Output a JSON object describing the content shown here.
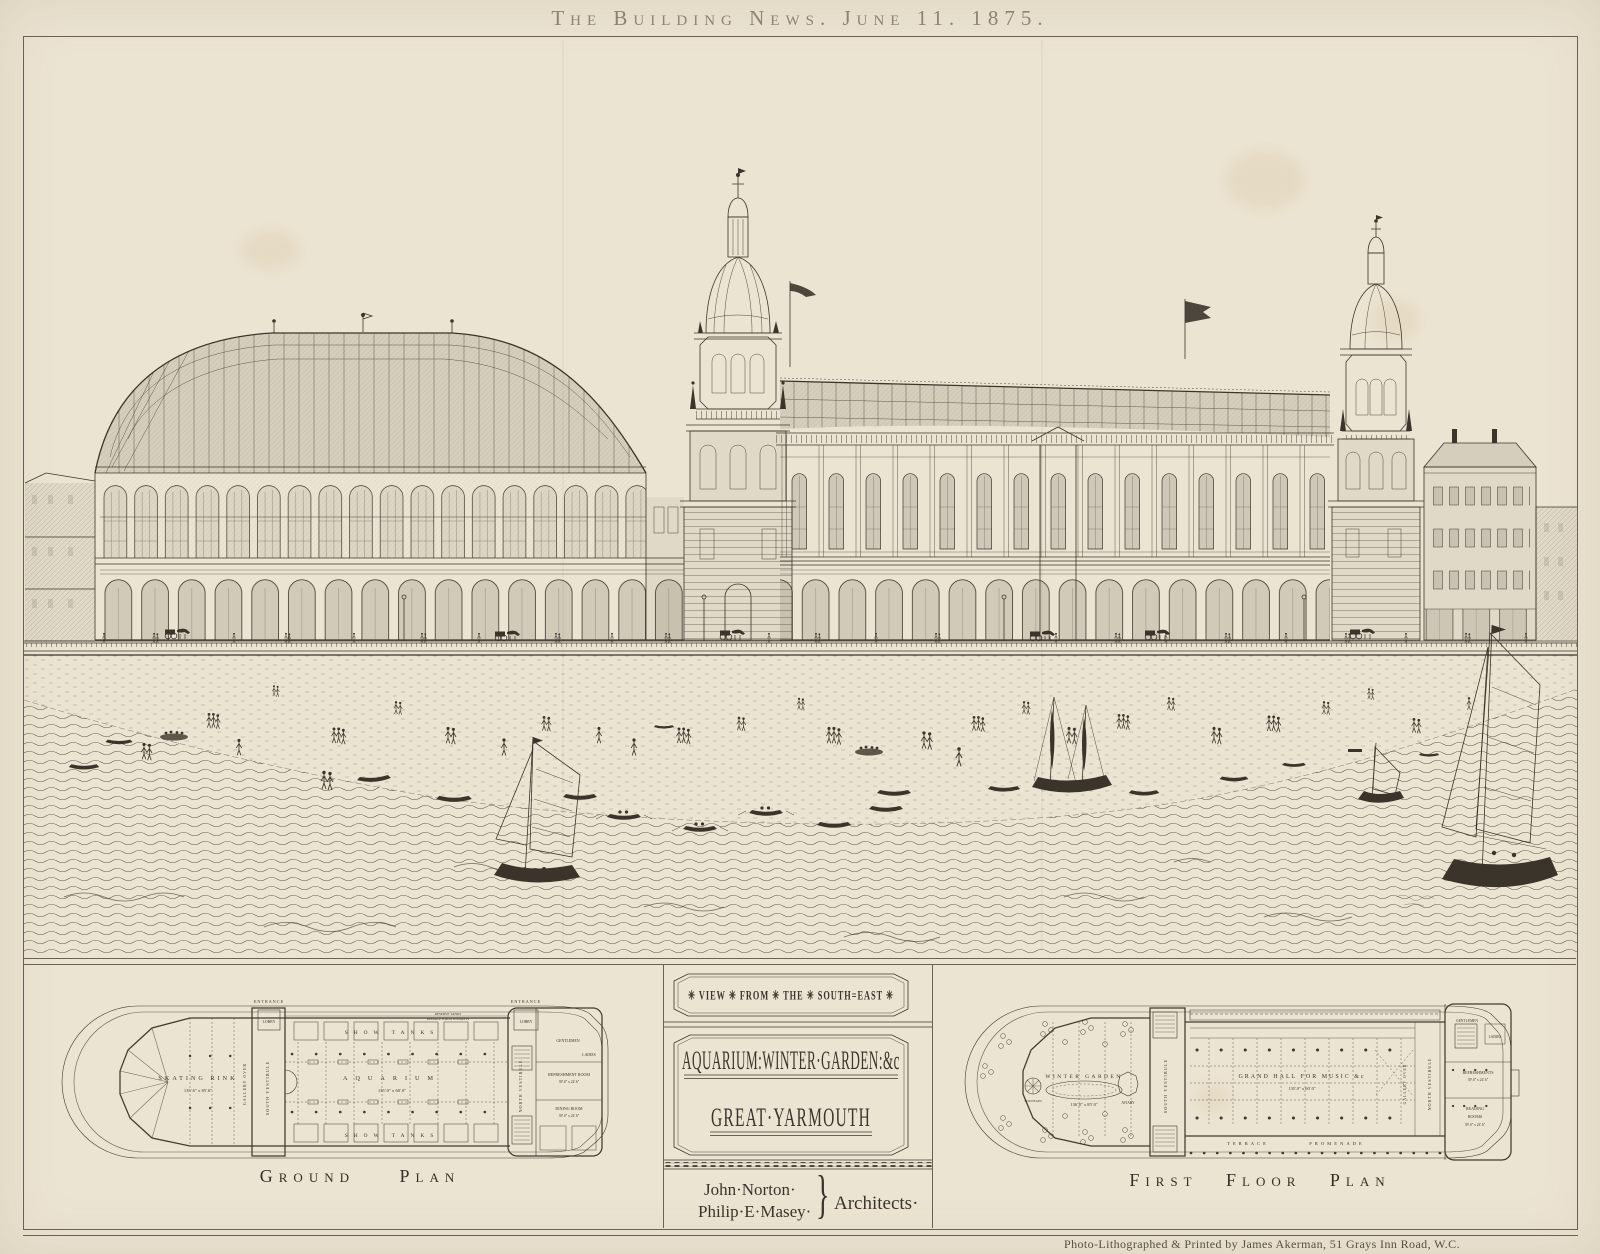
{
  "page": {
    "header": "The Building News. June 11. 1875.",
    "imprint": "Photo-Lithographed & Printed by James Akerman, 51 Grays Inn Road, W.C.",
    "colors": {
      "paper": "#ece4d2",
      "ink": "#3a342c",
      "header_ink": "#8e8270"
    }
  },
  "cartouche": {
    "view_caption": "✳ VIEW ✳ FROM ✳ THE ✳ SOUTH=EAST ✳",
    "title_line1": "AQUARIUM:WINTER·GARDEN:&c",
    "title_line2": "GREAT·YARMOUTH",
    "architect_1": "John·Norton·",
    "architect_2": "Philip·E·Masey·",
    "brace": "}",
    "architects_label": "Architects·"
  },
  "ground_plan": {
    "caption": "Ground Plan",
    "labels": {
      "entrance_left": "ENTRANCE",
      "entrance_right": "ENTRANCE",
      "lobby_left": "LOBBY",
      "lobby_right": "LOBBY",
      "gallery_over": "GALLERY OVER",
      "skating_rink": "SKATING RINK",
      "skating_rink_dims": "135'.6\" x 85'.6\"",
      "south_vestibule": "SOUTH VESTIBULE",
      "show_tanks_top": "SHOW TANKS",
      "show_tanks_bottom": "SHOW TANKS",
      "reserve_tanks": "RESERVE TANKS",
      "passage": "PASSAGE FOR ATTENDANTS",
      "aquarium": "AQUARIUM",
      "aquarium_dims": "135'.0\" x 60'.0\"",
      "north_vestibule": "NORTH VESTIBULE",
      "gentlemen": "GENTLEMEN",
      "ladies": "LADIES",
      "refreshment_room": "REFRESHMENT ROOM",
      "refreshment_dims": "39'.0\" x 24'.6\"",
      "dining_room": "DINING ROOM",
      "dining_dims": "39'.0\" x 24'.6\""
    }
  },
  "first_floor_plan": {
    "caption": "First Floor Plan",
    "labels": {
      "winter_garden": "WINTER GARDEN",
      "winter_garden_dims": "136'.0\" x 85'.0\"",
      "fountain": "FOUNTAIN",
      "aviary": "AVIARY",
      "south_vestibule": "SOUTH VESTIBULE",
      "grand_hall": "GRAND HALL FOR MUSIC &c",
      "grand_hall_dims": "135'.0\" x 60'.0\"",
      "gallery_over": "GALLERY OVER",
      "north_vestibule": "NORTH VESTIBULE",
      "gentlemen": "GENTLEMEN",
      "ladies": "LADIES",
      "refreshments": "REFRESHMENTS",
      "refreshments_dims": "39'.0\" x 24'.6\"",
      "reading_line1": "READING",
      "reading_line2": "ROOMS",
      "reading_dims": "39'.0\" x 24'.6\"",
      "terrace": "TERRACE",
      "promenade": "PROMENADE"
    }
  }
}
